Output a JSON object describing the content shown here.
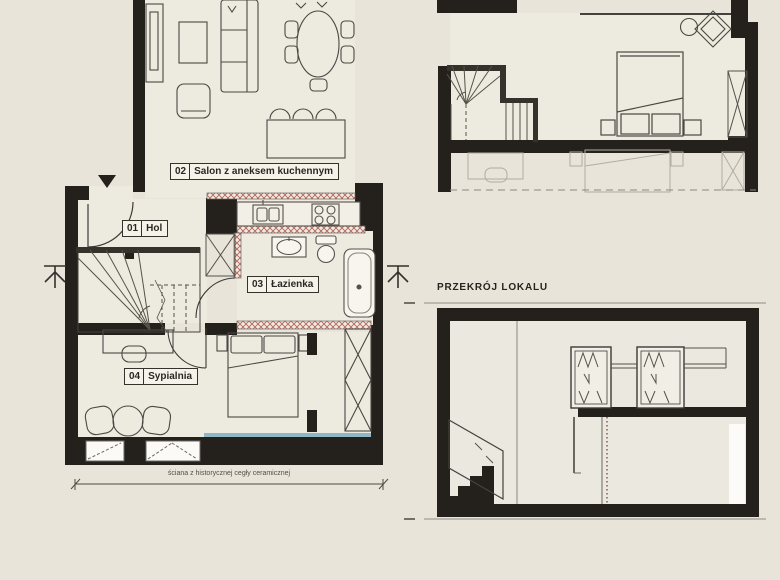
{
  "plan": {
    "rooms": [
      {
        "number": "01",
        "name": "Hol"
      },
      {
        "number": "02",
        "name": "Salon z aneksem kuchennym"
      },
      {
        "number": "03",
        "name": "Łazienka"
      },
      {
        "number": "04",
        "name": "Sypialnia"
      }
    ],
    "dimension_note": "ściana z historycznej cegły ceramicznej"
  },
  "section": {
    "title": "PRZEKRÓJ LOKALU"
  },
  "colors": {
    "background": "#e8e4da",
    "wall": "#24211c",
    "hatch_red": "#b5645c",
    "window_blue": "#8fb7c8",
    "line_dark": "#3c3a36",
    "line_faint": "#b0ada4"
  }
}
